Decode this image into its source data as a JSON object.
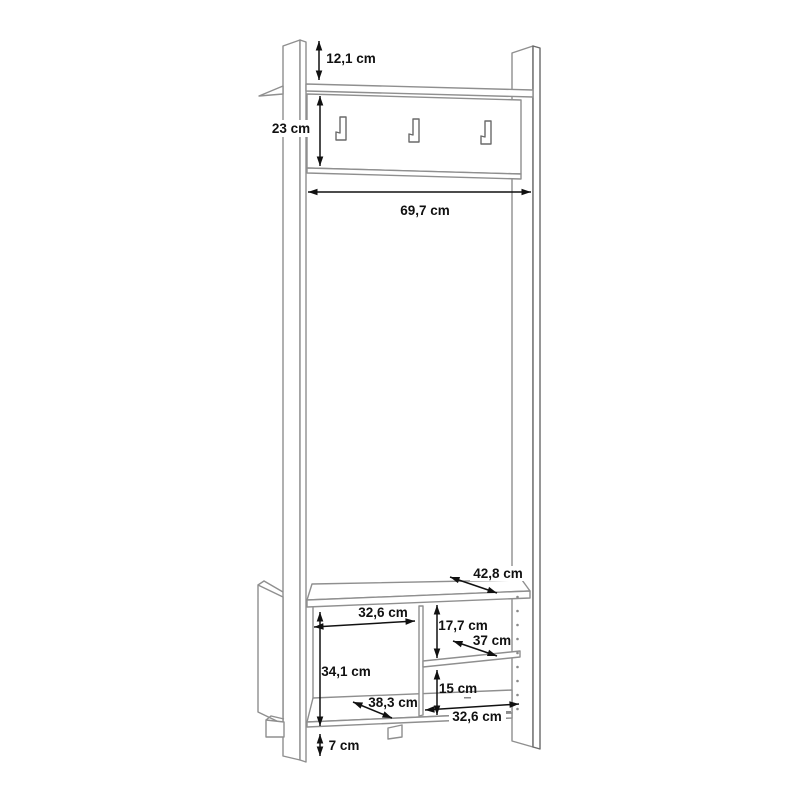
{
  "diagram": {
    "background": "#ffffff",
    "line_color": "#8f8f8f",
    "dimension_color": "#111111",
    "unit": "cm",
    "hook_count": 3,
    "labels": {
      "top_overhang": "12,1 cm",
      "panel_height": "23 cm",
      "panel_width": "69,7 cm",
      "bench_depth": "42,8 cm",
      "left_compartment_width": "32,6 cm",
      "right_upper_height": "17,7 cm",
      "shelf_depth": "37 cm",
      "left_compartment_height": "34,1 cm",
      "right_lower_height": "15 cm",
      "left_compartment_depth": "38,3 cm",
      "right_compartment_width": "32,6 cm",
      "foot_height": "7 cm"
    }
  }
}
